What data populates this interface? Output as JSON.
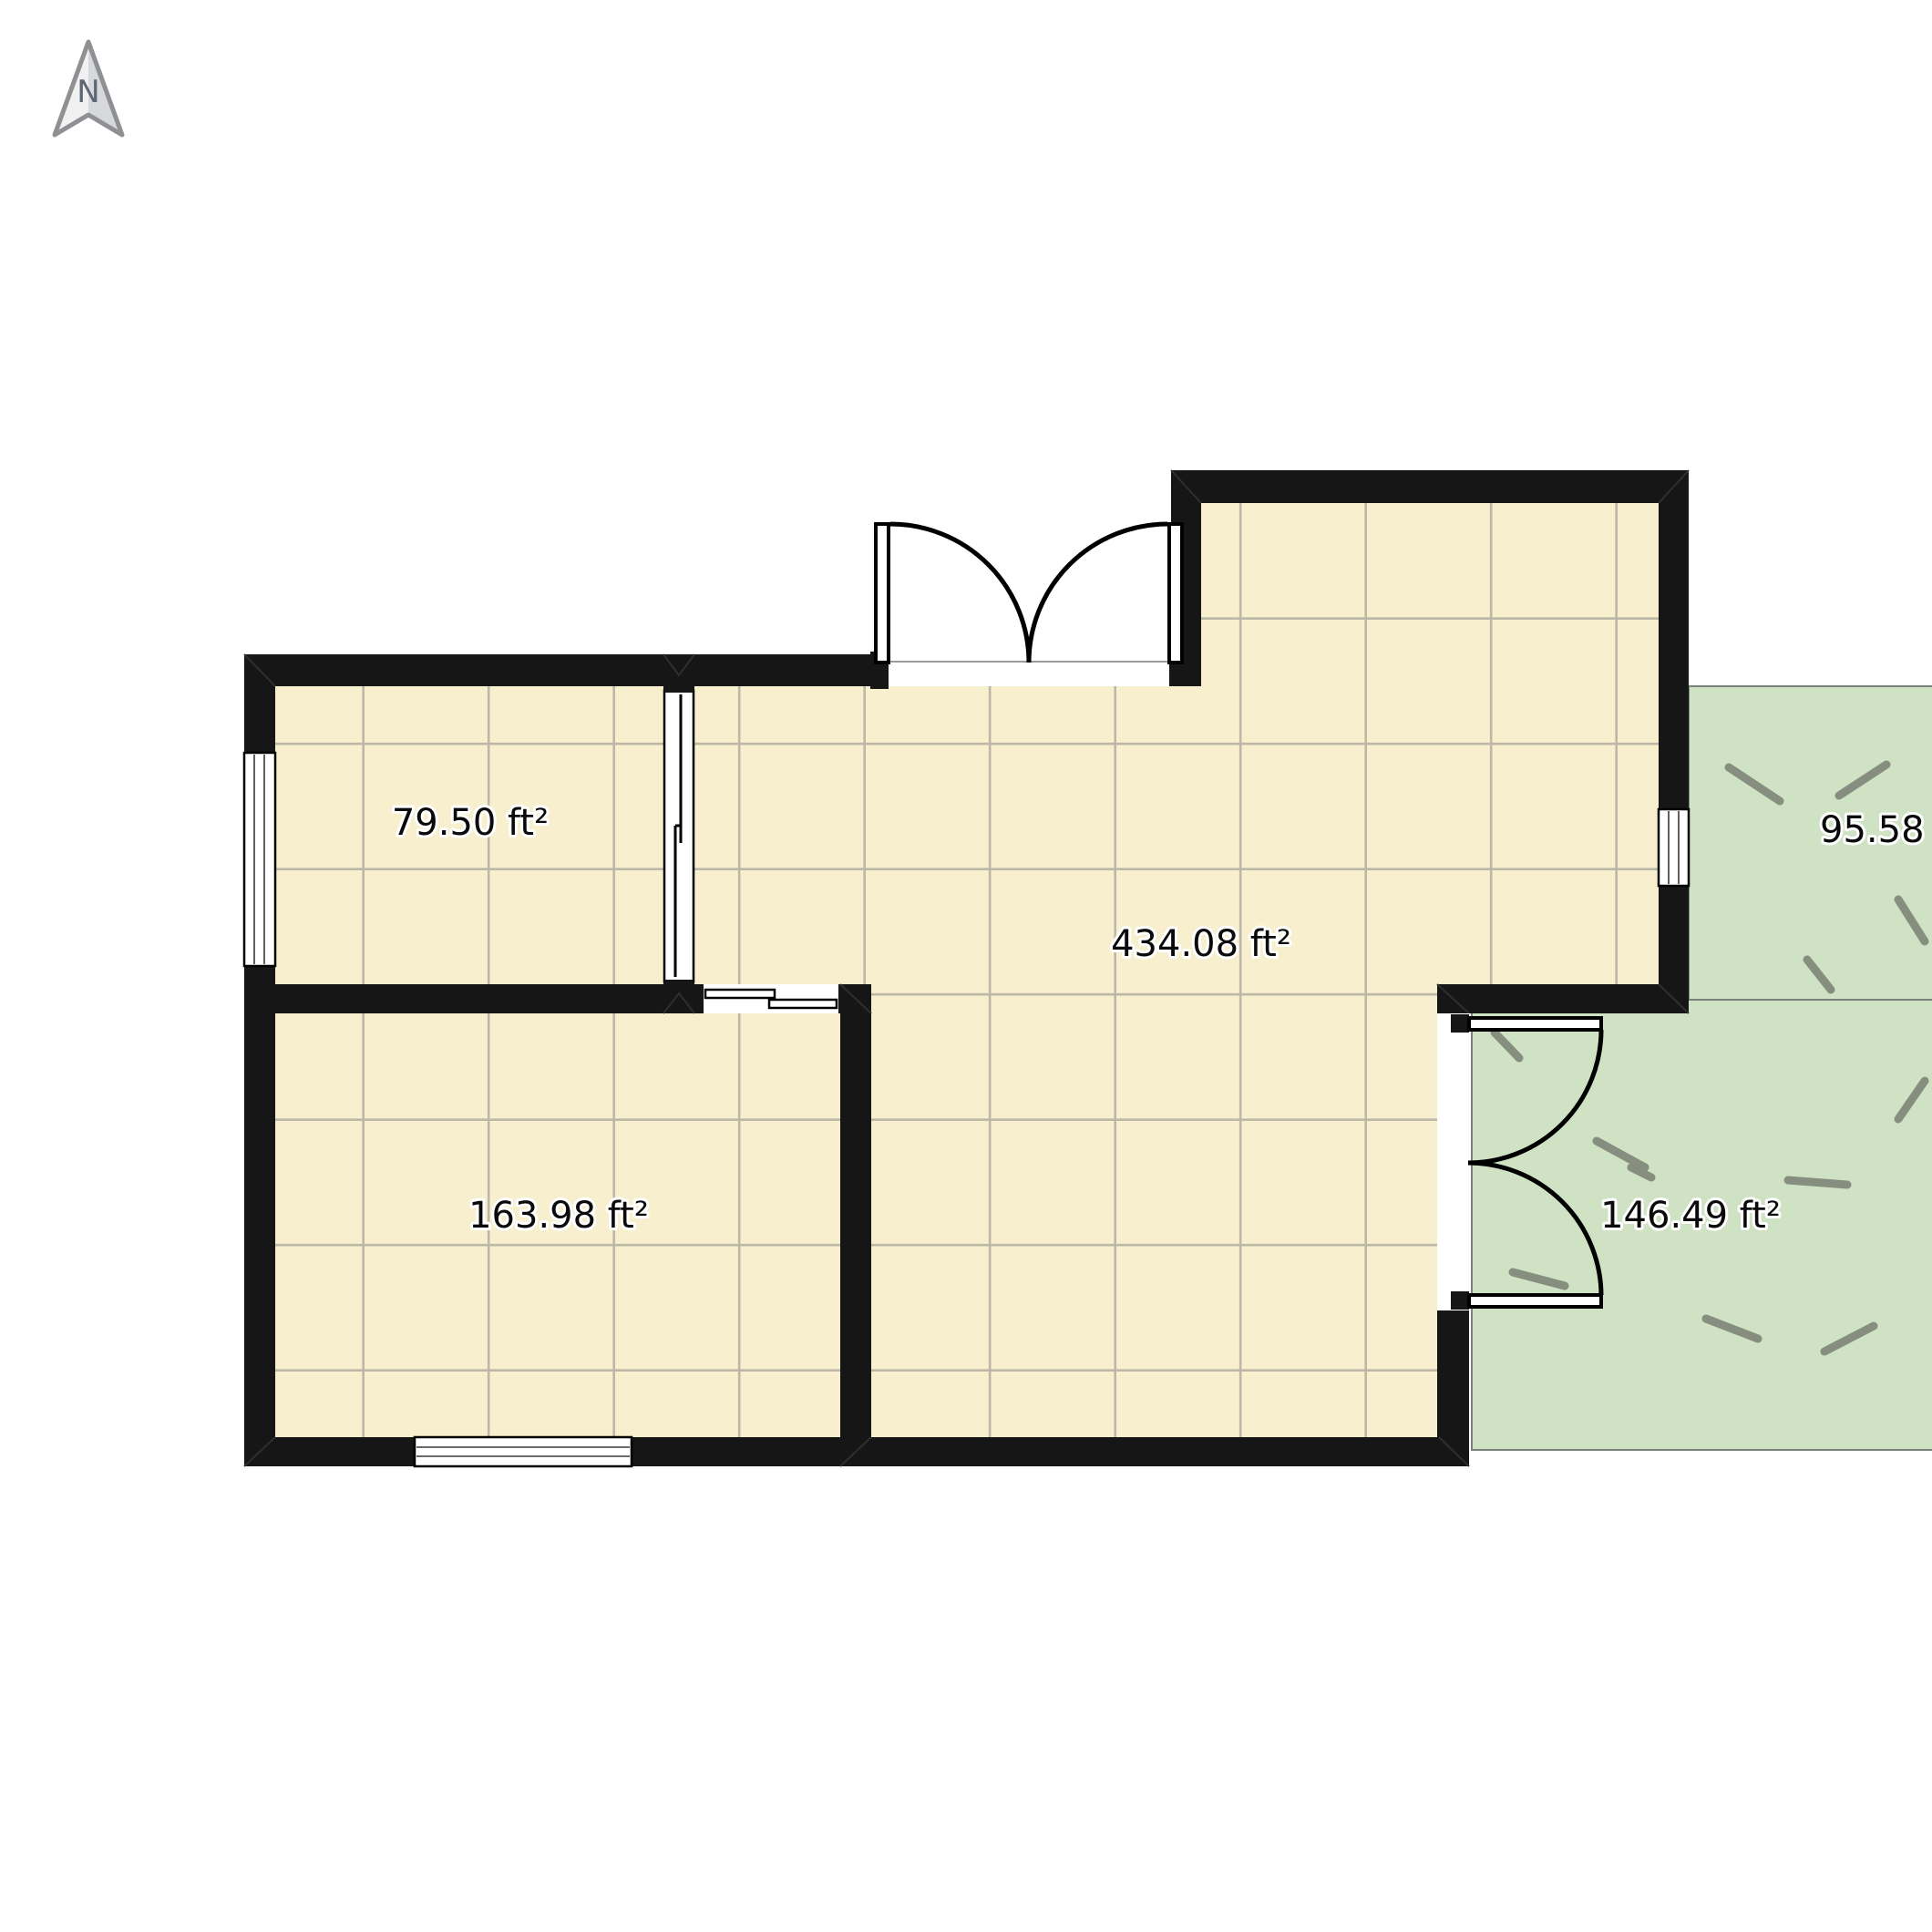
{
  "compass": {
    "label": "N"
  },
  "rooms": [
    {
      "name": "top-left-room",
      "area_label": "79.50 ft²"
    },
    {
      "name": "living-hall",
      "area_label": "434.08 ft²"
    },
    {
      "name": "bottom-left-room",
      "area_label": "163.98 ft²"
    },
    {
      "name": "patio",
      "area_label": "146.49 ft²"
    },
    {
      "name": "side-yard",
      "area_label": "95.58 ft²"
    }
  ],
  "colors": {
    "floor": "#f7efcd",
    "tile_line": "#bcb8a8",
    "wall": "#161616",
    "green": "#cfe3c4",
    "green_border": "#79817a",
    "grass_dash": "#868e7f",
    "label_text": "#0a0a0a",
    "compass_fill_light": "#f1f1f2",
    "compass_fill_dark": "#d7d8db",
    "compass_stroke": "#8f9094",
    "compass_letter": "#5d6673"
  }
}
